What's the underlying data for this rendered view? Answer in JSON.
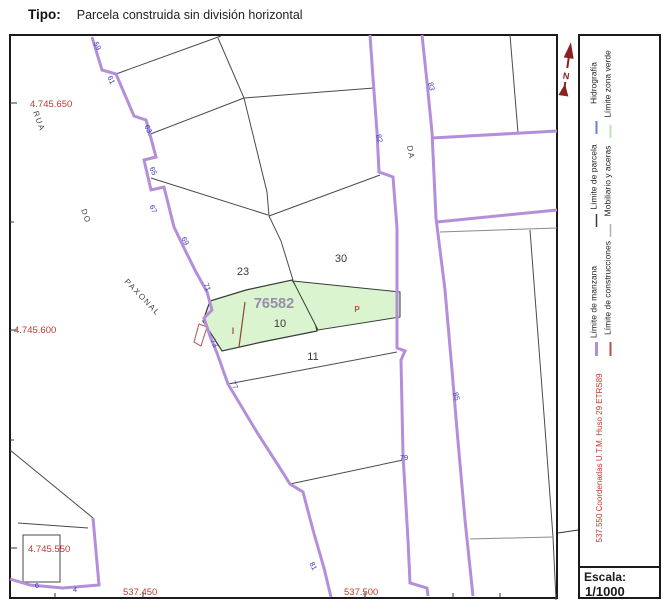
{
  "header": {
    "label": "Tipo:",
    "value": "Parcela construida sin división horizontal"
  },
  "map": {
    "parcel_ref": "76582",
    "parcel_numbers": {
      "p23": "23",
      "p30": "30",
      "p10": "10",
      "p11": "11"
    },
    "construction_marks": {
      "i": "I",
      "p": "P"
    },
    "streets": {
      "rua": "RUA",
      "do": "DO",
      "paxonal": "PAXONAL",
      "da": "DA"
    },
    "portal_numbers": {
      "n59": "59",
      "n61": "61",
      "n63": "63",
      "n65": "65",
      "n67": "67",
      "n69": "69",
      "n71": "71",
      "n73": "73",
      "n77": "77",
      "n79": "79",
      "n81": "81",
      "n82": "82",
      "n83": "83",
      "n85": "85",
      "n6": "6",
      "n4": "4"
    },
    "coords": {
      "y650": "4.745.650",
      "y600": "4.745.600",
      "y550": "4.745.550",
      "x450": "537.450",
      "x500": "537.500"
    }
  },
  "legend": {
    "items": [
      {
        "label": "Límite de parcela",
        "color": "#3a3a3a"
      },
      {
        "label": "Hidrografía",
        "color": "#6b7fd7"
      },
      {
        "label": "Mobiliario y aceras",
        "color": "#b0b0b0"
      },
      {
        "label": "Límite zona verde",
        "color": "#bfe3ad"
      },
      {
        "label": "Límite de manzana",
        "color": "#b48fd9"
      },
      {
        "label": "Límite de construcciones",
        "color": "#b5524a"
      }
    ],
    "coordinate_note": "537.550 Coordenadas U.T.M. Huso 29 ETRS89",
    "north_label": "N",
    "scale": {
      "label": "Escala:",
      "value": "1/1000"
    }
  },
  "colors": {
    "manzana": "#b48fd9",
    "construcciones": "#b5524a",
    "parcel_green": "#d9f4ce",
    "portal_blue": "#3b3bbd",
    "coord_red": "#c0392b",
    "ref_label": "#978cae",
    "north": "#8b2020"
  }
}
